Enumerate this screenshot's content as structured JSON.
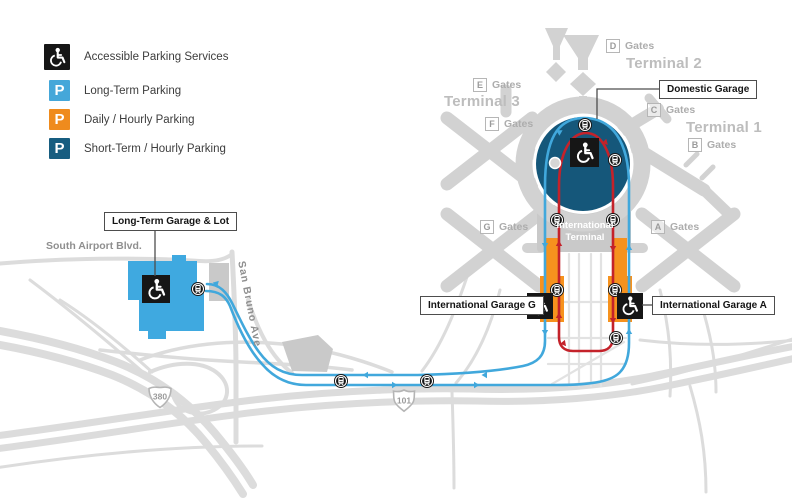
{
  "legend": {
    "p_letter": "P",
    "items": [
      {
        "icon": "accessible-icon",
        "label": "Accessible Parking Services",
        "color": "#161616"
      },
      {
        "icon": "p-icon",
        "label": "Long-Term Parking",
        "color": "#45a7d9"
      },
      {
        "icon": "p-icon",
        "label": "Daily / Hourly Parking",
        "color": "#ef8b1d"
      },
      {
        "icon": "p-icon",
        "label": "Short-Term / Hourly Parking",
        "color": "#175d80"
      }
    ]
  },
  "terminals": {
    "t1": "Terminal 1",
    "t2": "Terminal 2",
    "t3": "Terminal 3"
  },
  "gates": {
    "word": "Gates",
    "a": "A",
    "b": "B",
    "c": "C",
    "d": "D",
    "e": "E",
    "f": "F",
    "g": "G"
  },
  "callouts": {
    "domestic_garage": "Domestic Garage",
    "long_term_garage": "Long-Term Garage & Lot",
    "intl_garage_g": "International Garage G",
    "intl_garage_a": "International Garage A"
  },
  "map_labels": {
    "intl_terminal_line1": "International",
    "intl_terminal_line2": "Terminal",
    "south_airport_blvd": "South Airport Blvd.",
    "san_bruno_ave": "San Bruno Ave"
  },
  "shields": {
    "i380": "380",
    "us101": "101"
  },
  "colors": {
    "long_term_blue": "#45a7d9",
    "daily_orange": "#ef8b1d",
    "short_term_teal": "#175d80",
    "route_red": "#c4222a",
    "route_blue": "#41a8dc",
    "lot_blue": "#3fa9e0",
    "garage_orange": "#f6921e",
    "terminal_gray": "#d2d2d2",
    "road_gray": "#dcdcdc",
    "hourly_circle_teal": "#15577a"
  }
}
